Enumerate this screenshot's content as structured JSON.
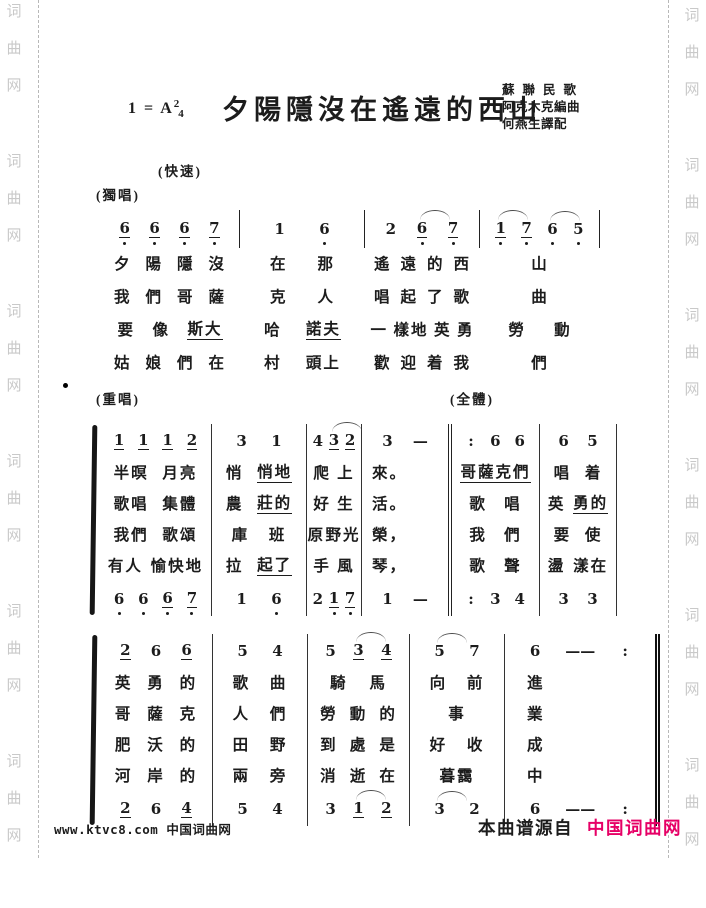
{
  "header": {
    "key": "1 = A",
    "meter_num": "2",
    "meter_den": "4",
    "title": "夕陽隱沒在遙遠的西山",
    "credits": [
      "蘇聯民歌",
      "阿克木克編曲",
      "何燕生譯配"
    ],
    "tempo": "(快速)",
    "solo_label": "(獨唱)"
  },
  "section_labels": {
    "duet": "(重唱)",
    "all": "(全體)"
  },
  "watermark": {
    "chars": [
      "词",
      "曲",
      "网"
    ],
    "groups": 6
  },
  "systems": [
    {
      "id": "system-1",
      "rows": [
        {
          "kind": "notes",
          "cells": [
            [
              "6u.",
              "6u.",
              "6u.",
              "7u."
            ],
            [
              "1",
              "6."
            ],
            [
              "2",
              "6u.~",
              "7u."
            ],
            [
              "1u.~",
              "7u.",
              "6.~",
              "5."
            ]
          ]
        },
        {
          "kind": "lyrics",
          "cells": [
            [
              "夕",
              "陽",
              "隱",
              "沒"
            ],
            [
              "在",
              "那"
            ],
            [
              "遙",
              "遠",
              "的",
              "西"
            ],
            [
              "山"
            ]
          ]
        },
        {
          "kind": "lyrics",
          "cells": [
            [
              "我",
              "們",
              "哥",
              "薩"
            ],
            [
              "克",
              "人"
            ],
            [
              "唱",
              "起",
              "了",
              "歌"
            ],
            [
              "曲"
            ]
          ]
        },
        {
          "kind": "lyrics",
          "cells": [
            [
              "要",
              "像",
              "_斯大"
            ],
            [
              "哈",
              "_諾夫"
            ],
            [
              "一",
              "樣地",
              "英",
              "勇"
            ],
            [
              "勞",
              "動"
            ]
          ]
        },
        {
          "kind": "lyrics",
          "cells": [
            [
              "姑",
              "娘",
              "們",
              "在"
            ],
            [
              "村",
              "頭上"
            ],
            [
              "歡",
              "迎",
              "着",
              "我"
            ],
            [
              "們"
            ]
          ]
        }
      ]
    },
    {
      "id": "system-2",
      "rows": [
        {
          "kind": "notes",
          "cells": [
            [
              "1u",
              "1u",
              "1u",
              "2u"
            ],
            [
              "3",
              "1"
            ],
            [
              "4",
              "3u~",
              "2u"
            ],
            [
              "3",
              "—"
            ],
            [
              ":",
              "6",
              "6"
            ],
            [
              "6",
              "5"
            ]
          ]
        },
        {
          "kind": "lyrics",
          "cells": [
            [
              "半暝",
              "月亮"
            ],
            [
              "悄",
              "_悄地"
            ],
            [
              "爬",
              "上"
            ],
            [
              "來。"
            ],
            [
              "_哥薩克們"
            ],
            [
              "唱",
              "着"
            ]
          ]
        },
        {
          "kind": "lyrics",
          "cells": [
            [
              "歌唱",
              "集體"
            ],
            [
              "農",
              "_莊的"
            ],
            [
              "好",
              "生"
            ],
            [
              "活。"
            ],
            [
              "歌",
              "唱"
            ],
            [
              "英",
              "_勇的"
            ]
          ]
        },
        {
          "kind": "lyrics",
          "cells": [
            [
              "我們",
              "歌頌"
            ],
            [
              "庫",
              "班"
            ],
            [
              "原",
              "野光"
            ],
            [
              "榮，"
            ],
            [
              "我",
              "們"
            ],
            [
              "要",
              "使"
            ]
          ]
        },
        {
          "kind": "lyrics",
          "cells": [
            [
              "有人",
              "愉快地"
            ],
            [
              "拉",
              "_起了"
            ],
            [
              "手",
              "風"
            ],
            [
              "琴，"
            ],
            [
              "歌",
              "聲"
            ],
            [
              "盪",
              "漾在"
            ]
          ]
        },
        {
          "kind": "notes",
          "cells": [
            [
              "6.",
              "6.",
              "6u.",
              "7u."
            ],
            [
              "1",
              "6."
            ],
            [
              "2",
              "1u.",
              "7u."
            ],
            [
              "1",
              "—"
            ],
            [
              ":",
              "3",
              "4"
            ],
            [
              "3",
              "3"
            ]
          ]
        }
      ]
    },
    {
      "id": "system-3",
      "rows": [
        {
          "kind": "notes",
          "cells": [
            [
              "2u",
              "6",
              "6u"
            ],
            [
              "5",
              "4"
            ],
            [
              "5",
              "3u~",
              "4u"
            ],
            [
              "5~",
              "7"
            ],
            [
              "6",
              "——",
              ":"
            ]
          ]
        },
        {
          "kind": "lyrics",
          "cells": [
            [
              "英",
              "勇",
              "的"
            ],
            [
              "歌",
              "曲"
            ],
            [
              "騎",
              "馬"
            ],
            [
              "向",
              "前"
            ],
            [
              "進"
            ]
          ]
        },
        {
          "kind": "lyrics",
          "cells": [
            [
              "哥",
              "薩",
              "克"
            ],
            [
              "人",
              "們"
            ],
            [
              "勞",
              "動",
              "的"
            ],
            [
              "事"
            ],
            [
              "業"
            ]
          ]
        },
        {
          "kind": "lyrics",
          "cells": [
            [
              "肥",
              "沃",
              "的"
            ],
            [
              "田",
              "野"
            ],
            [
              "到",
              "處",
              "是"
            ],
            [
              "好",
              "收"
            ],
            [
              "成"
            ]
          ]
        },
        {
          "kind": "lyrics",
          "cells": [
            [
              "河",
              "岸",
              "的"
            ],
            [
              "兩",
              "旁"
            ],
            [
              "消",
              "逝",
              "在"
            ],
            [
              "暮靄"
            ],
            [
              "中"
            ]
          ]
        },
        {
          "kind": "notes",
          "cells": [
            [
              "2u",
              "6",
              "4u"
            ],
            [
              "5",
              "4"
            ],
            [
              "3",
              "1u~",
              "2u"
            ],
            [
              "3~",
              "2"
            ],
            [
              "6",
              "——",
              ":"
            ]
          ]
        }
      ]
    }
  ],
  "footer": {
    "site_left": "www.ktvc8.com 中国词曲网",
    "source_prefix": "本曲谱源自",
    "brand": "中国词曲网",
    "brand_color": "#e60066",
    "watermark_color": "#c9c9c9"
  }
}
